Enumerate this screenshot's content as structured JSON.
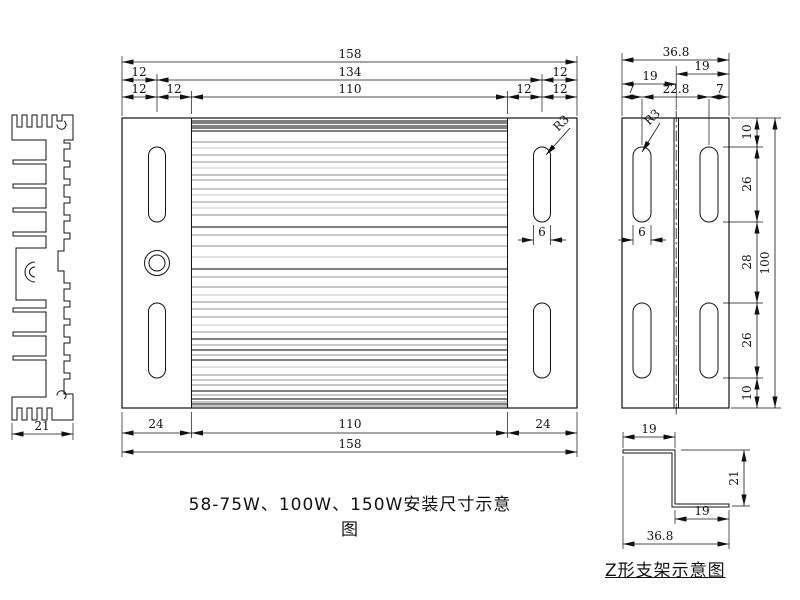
{
  "captions": {
    "main": "58-75W、100W、150W安装尺寸示意图",
    "bracket": "Z形支架示意图"
  },
  "colors": {
    "line": "#111111",
    "background": "#ffffff"
  },
  "main_view": {
    "dim_total_top": "158",
    "dim_row2": [
      "12",
      "134",
      "12"
    ],
    "dim_row3": [
      "12",
      "12",
      "110",
      "12",
      "12"
    ],
    "dim_bottom_chain": [
      "24",
      "110",
      "24"
    ],
    "dim_total_bottom": "158",
    "slot_radius": "R3",
    "slot_width": "6"
  },
  "side_view": {
    "dim_total_width": "36.8",
    "dim_left": "19",
    "dim_right": "19",
    "dim_chain_top": [
      "7",
      "22.8",
      "7"
    ],
    "dim_chain_right": [
      "10",
      "26",
      "28",
      "26",
      "10"
    ],
    "dim_total_height": "100",
    "slot_radius": "R3",
    "slot_width": "6"
  },
  "profile_view": {
    "dim_width": "21"
  },
  "z_bracket": {
    "dim_top": "19",
    "dim_height": "21",
    "dim_bottom_inner": "19",
    "dim_bottom_total": "36.8"
  },
  "fin_lines": {
    "shades": {
      "k": "#000000",
      "g": "#8f8f8f",
      "l": "#c8c8c8"
    },
    "lines": [
      [
        3,
        "k"
      ],
      [
        5,
        "k"
      ],
      [
        8,
        "k"
      ],
      [
        10,
        "k"
      ],
      [
        13,
        "k"
      ],
      [
        24,
        "g"
      ],
      [
        30,
        "l"
      ],
      [
        37,
        "g"
      ],
      [
        44,
        "g"
      ],
      [
        50,
        "l"
      ],
      [
        57,
        "g"
      ],
      [
        62,
        "g"
      ],
      [
        71,
        "g"
      ],
      [
        77,
        "l"
      ],
      [
        84,
        "g"
      ],
      [
        90,
        "l"
      ],
      [
        97,
        "g"
      ],
      [
        109,
        "k"
      ],
      [
        117,
        "g"
      ],
      [
        128,
        "g"
      ],
      [
        139,
        "l"
      ],
      [
        151,
        "k"
      ],
      [
        159,
        "g"
      ],
      [
        169,
        "g"
      ],
      [
        177,
        "l"
      ],
      [
        184,
        "g"
      ],
      [
        191,
        "g"
      ],
      [
        199,
        "g"
      ],
      [
        207,
        "l"
      ],
      [
        214,
        "g"
      ],
      [
        221,
        "k"
      ],
      [
        227,
        "g"
      ],
      [
        232,
        "k"
      ],
      [
        237,
        "g"
      ],
      [
        242,
        "k"
      ],
      [
        249,
        "l"
      ],
      [
        257,
        "g"
      ],
      [
        262,
        "g"
      ],
      [
        267,
        "g"
      ],
      [
        273,
        "k"
      ],
      [
        277,
        "g"
      ],
      [
        281,
        "k"
      ],
      [
        284,
        "g"
      ],
      [
        286,
        "k"
      ],
      [
        288,
        "g"
      ]
    ]
  }
}
